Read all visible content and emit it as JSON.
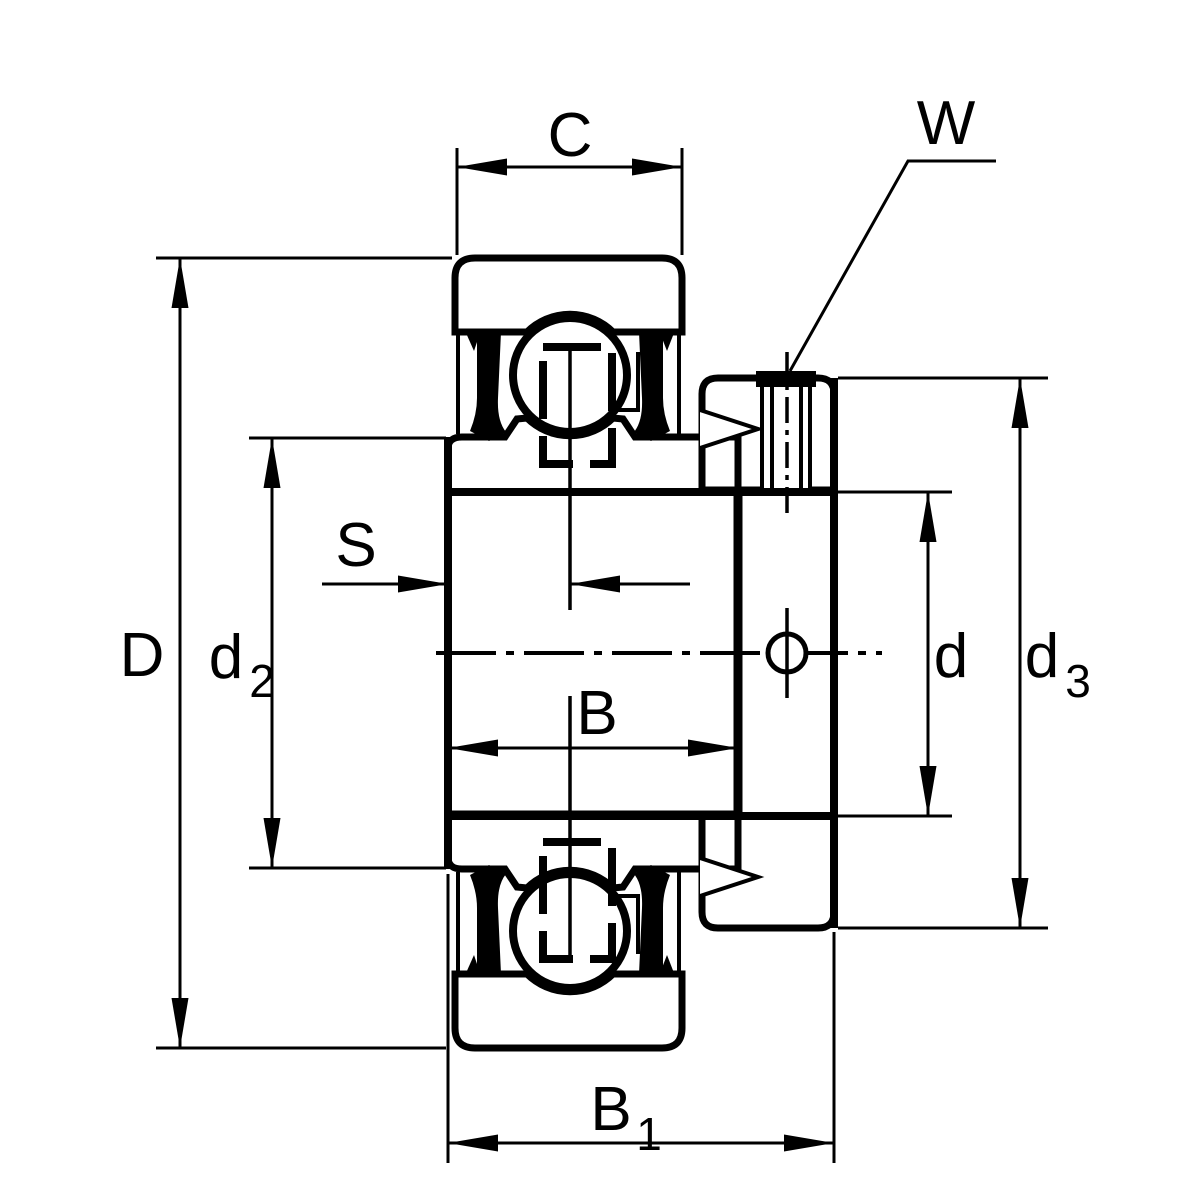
{
  "drawing": {
    "subject": "Radial insert ball bearing with eccentric locking collar and set screw - dimensional section drawing",
    "background_color": "#ffffff",
    "line_color": "#000000",
    "dimensions": {
      "C": "C",
      "W": "W",
      "D": "D",
      "S": "S",
      "B": "B",
      "d": "d",
      "d2_base": "d",
      "d2_sub": "2",
      "d3_base": "d",
      "d3_sub": "3",
      "B1_base": "B",
      "B1_sub": "1"
    }
  }
}
